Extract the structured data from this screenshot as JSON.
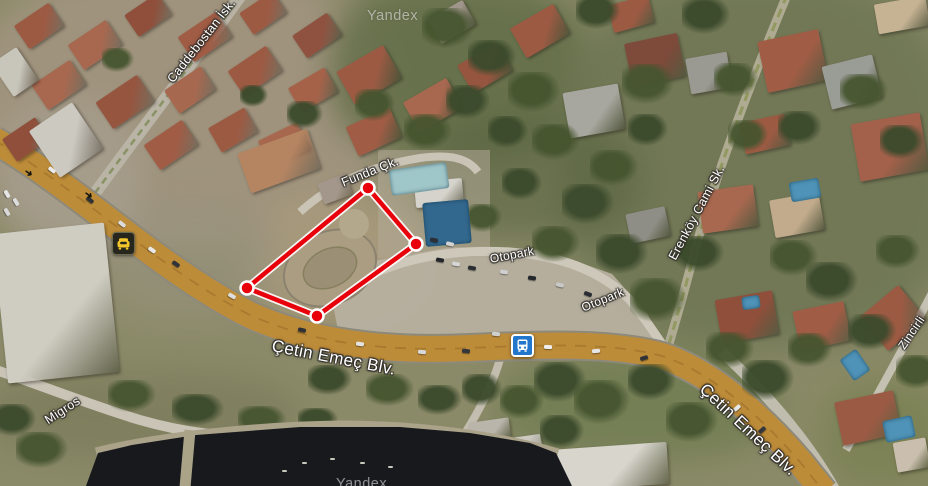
{
  "map": {
    "watermark": {
      "text": "Yandex"
    },
    "road_labels": {
      "caddebostan_isk": "Caddebostan İsk.",
      "funda_ck": "Funda Çk.",
      "otopark_upper": "Otopark",
      "otopark_lower": "Otopark",
      "cetin_emec_center": "Çetin Emeç Blv.",
      "cetin_emec_right": "Çetin Emeç Blv.",
      "erenkoy_cami_sk": "Erenköy Cami Sk.",
      "migros": "Migros",
      "zincirli": "Zincirli"
    },
    "icons": {
      "bus_stop": "bus-stop",
      "traffic_event": "car-taxi"
    },
    "selection": {
      "color": "#e8000a",
      "halo_color": "#ffffff",
      "vertex_fill": "#e8000a",
      "vertex_stroke": "#ffffff",
      "vertices": [
        [
          368,
          188
        ],
        [
          416,
          244
        ],
        [
          317,
          316
        ],
        [
          247,
          288
        ]
      ]
    },
    "colors": {
      "road_primary": "#bd8c39",
      "road_secondary": "#cdc8ba",
      "water": "#17191d",
      "bus_icon_blue": "#2276cb",
      "taxi_icon_yellow": "#f2c52c"
    }
  }
}
